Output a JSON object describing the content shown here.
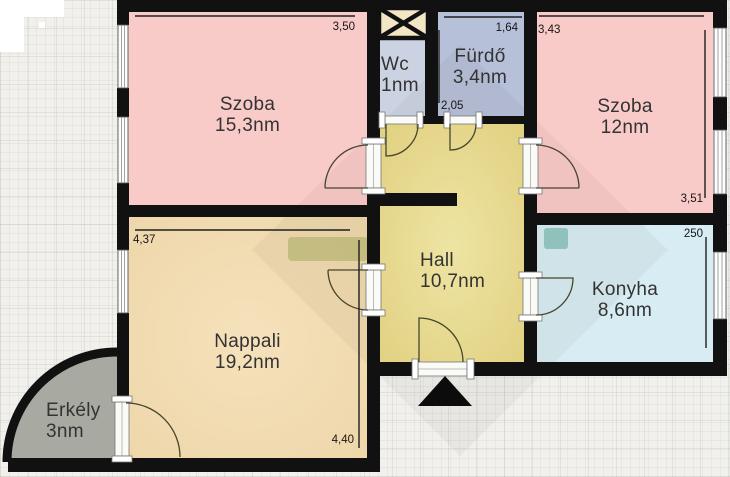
{
  "plan": {
    "rooms": [
      {
        "name": "Szoba",
        "area": "15,3nm"
      },
      {
        "name": "Wc",
        "area": "1nm"
      },
      {
        "name": "Fürdő",
        "area": "3,4nm"
      },
      {
        "name": "Szoba",
        "area": "12nm"
      },
      {
        "name": "Hall",
        "area": "10,7nm"
      },
      {
        "name": "Konyha",
        "area": "8,6nm"
      },
      {
        "name": "Nappali",
        "area": "19,2nm"
      },
      {
        "name": "Erkély",
        "area": "3nm"
      }
    ],
    "dimensions": {
      "szoba1_width": "3,50",
      "furdo_width": "1,64",
      "furdo_depth": "2,05",
      "szoba2_width": "3,43",
      "szoba2_depth": "3,51",
      "nappali_width": "4,37",
      "nappali_depth": "4,40",
      "konyha_depth": "250"
    },
    "colors": {
      "wall": "#111111",
      "room_pink": "#f9cbc8",
      "hall_center": "#f7edaa",
      "hall_edge": "#e9d985",
      "nappali_center": "#f5e1bb",
      "nappali_edge": "#eed6a9",
      "konyha_blue": "#d7ecf3",
      "furdo_blue": "#b7c0d9",
      "wc_blue": "#cbd3e3",
      "erkely_gray": "#a8a9a1",
      "shaft_cream": "#f3e6c4",
      "window_white": "#fdfdfd"
    }
  }
}
